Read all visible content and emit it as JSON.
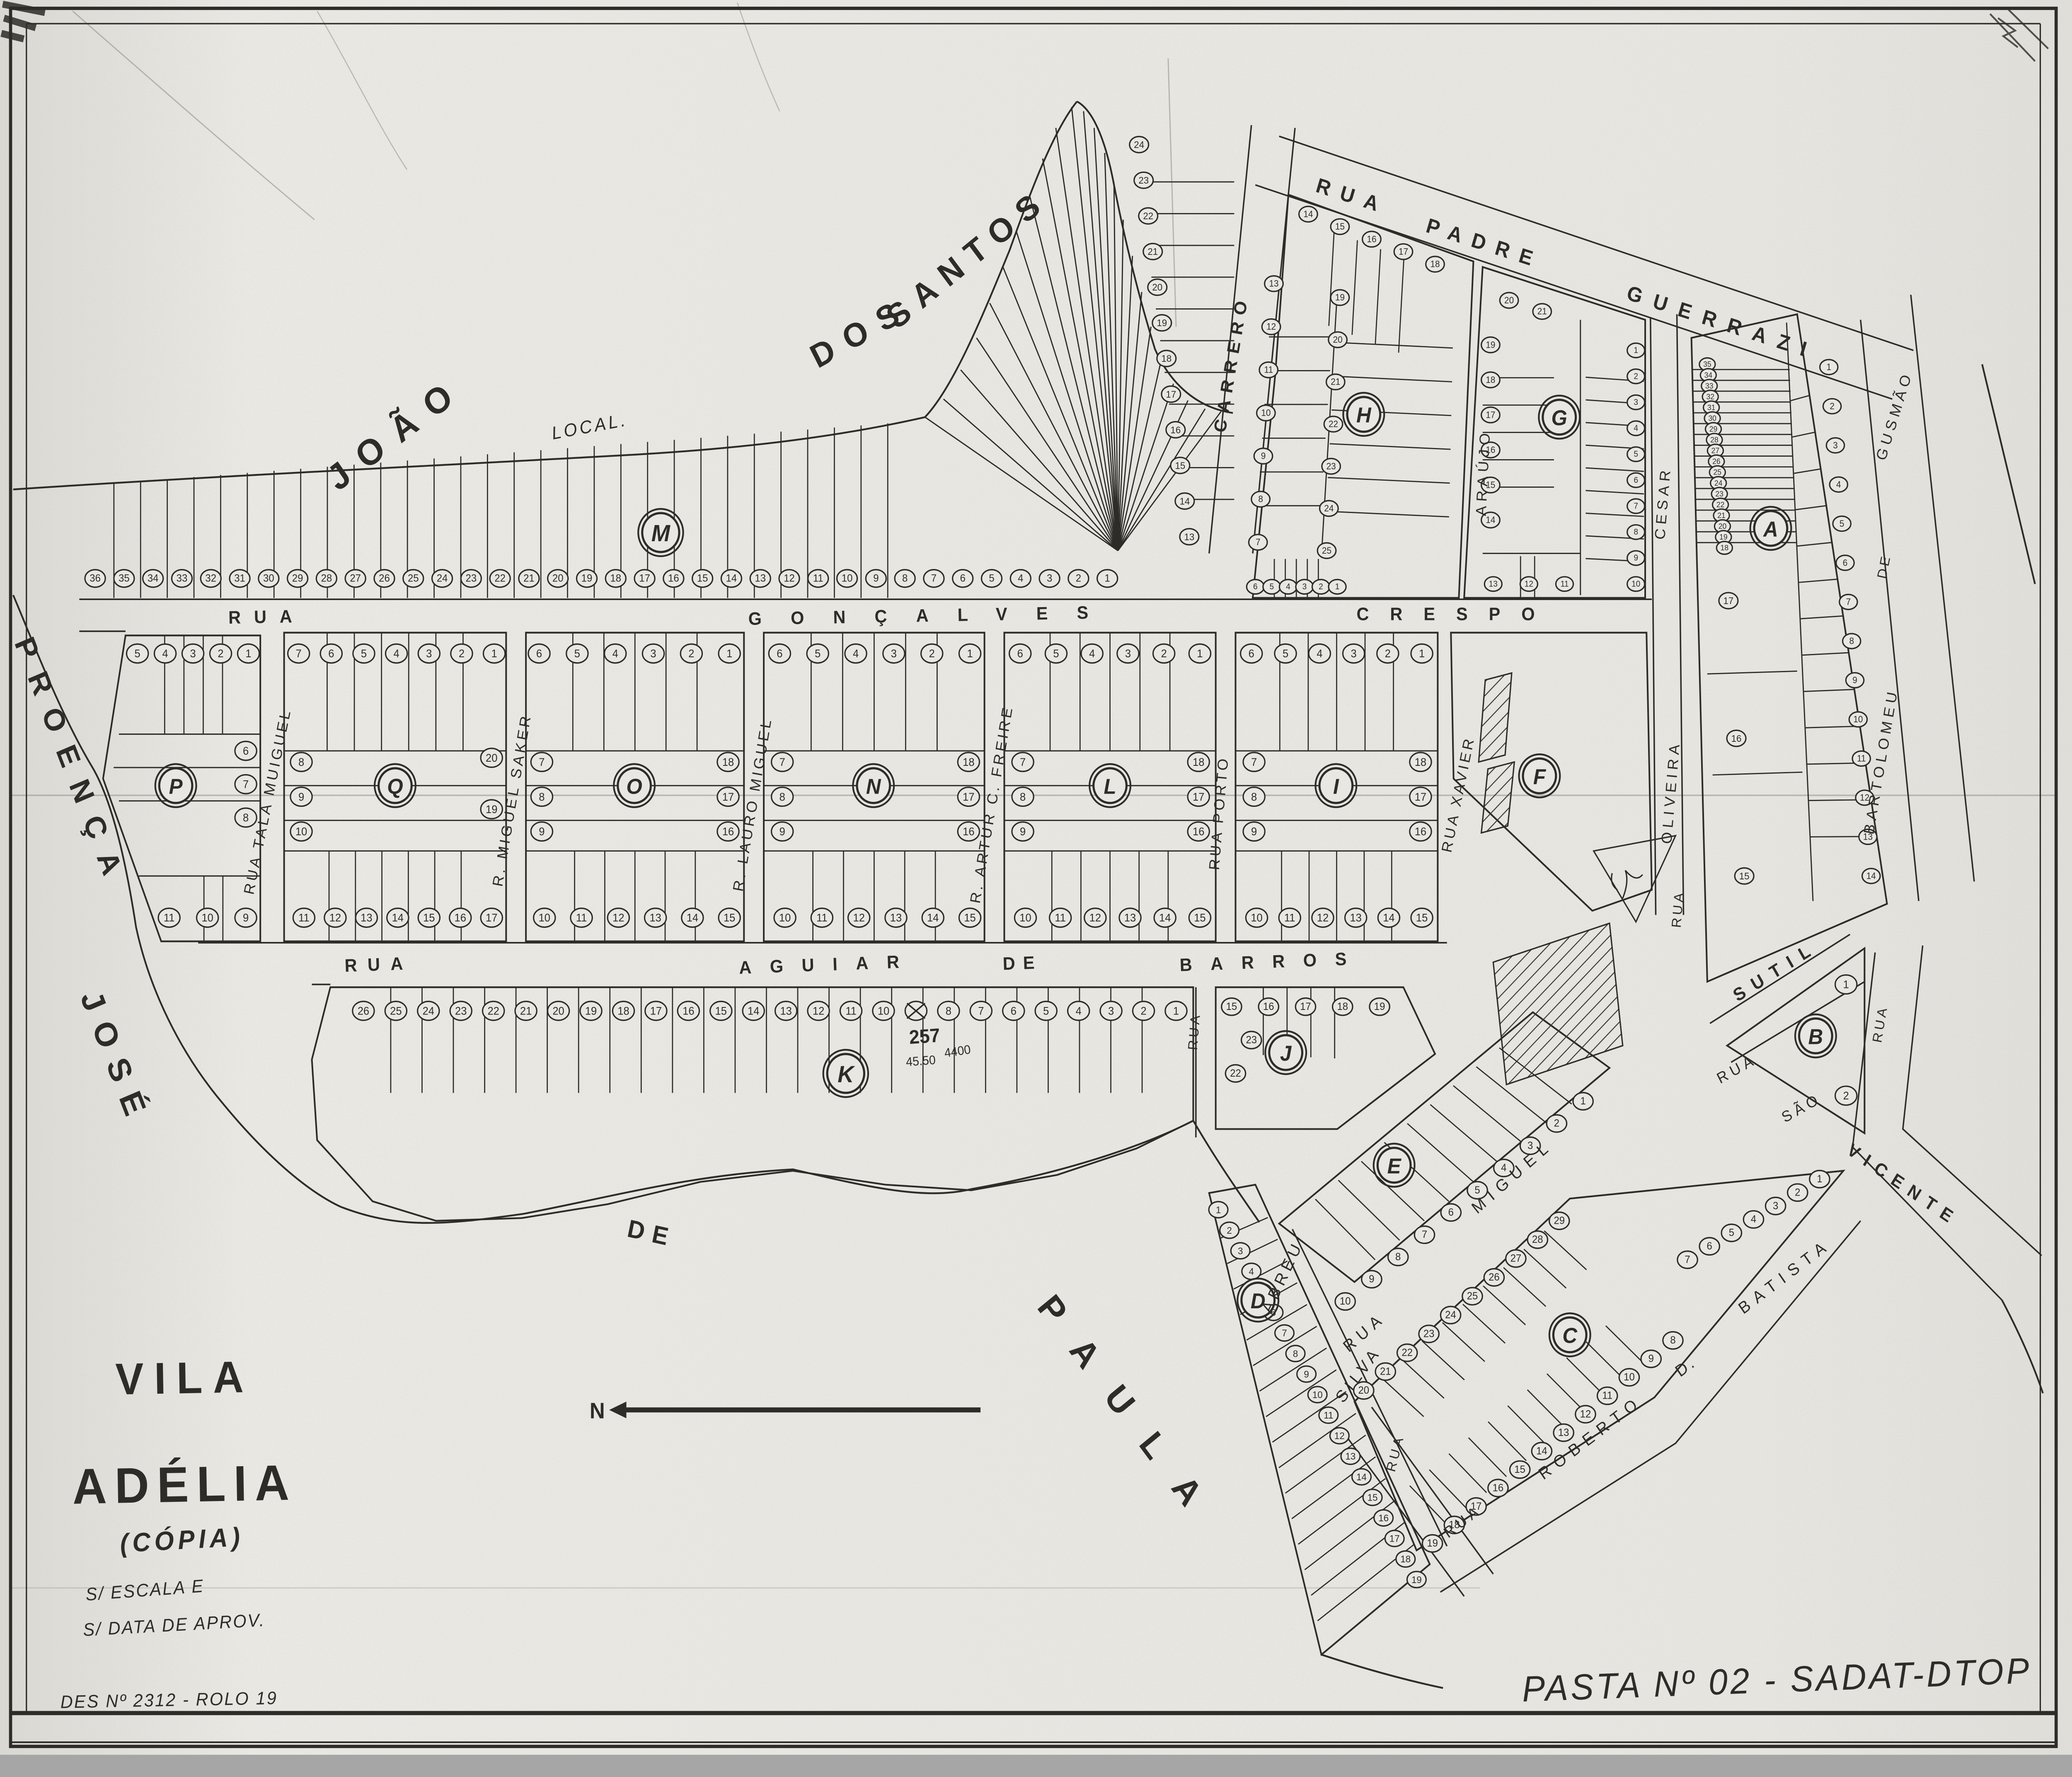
{
  "colors": {
    "ink": "#2e2c28",
    "paper": "#e9e7e2"
  },
  "title": {
    "word1": "VILA",
    "word2": "ADÉLIA",
    "subtitle": "(CÓPIA)",
    "note_line1": "S/ ESCALA E",
    "note_line2": "S/ DATA DE APROV."
  },
  "footer": {
    "drawing_ref": "DES Nº 2312 - ROLO 19",
    "folder_ref": "PASTA Nº 02 - SADAT-DTOP"
  },
  "north_indicator": "N",
  "boundaries": {
    "north_owner": [
      "JOÃO",
      "DOS",
      "SANTOS"
    ],
    "north_note": "LOCAL.",
    "west_owner": "PROENÇA",
    "south_owner_1": "JOSÉ",
    "south_owner_2": "DE",
    "south_owner_3": "PAULA"
  },
  "annotations": {
    "k_numbers": [
      "257",
      "45.50",
      "4400"
    ]
  },
  "streets": {
    "padre_guerrazi": [
      "RUA",
      "PADRE",
      "GUERRAZI"
    ],
    "carrero": "CARRERO",
    "araujo": "ARAÚJO",
    "goncalves_crespo": [
      "RUA",
      "GONÇALVES",
      "CRESPO"
    ],
    "aguiar_de_barros": [
      "RUA",
      "AGUIAR",
      "DE",
      "BARROS"
    ],
    "tala_muiguel": "RUA TALA MUIGUEL",
    "miguel_saker": "R. MIGUEL SAKER",
    "lauro_miguel": "R. LAURO MIGUEL",
    "artur_c_freire": "R. ARTUR C. FREIRE",
    "porto": "RUA PORTO",
    "xavier": "RUA XAVIER",
    "oliveira_cesar": [
      "RUA",
      "OLIVEIRA",
      "CESAR"
    ],
    "bartolomeu_de_gusmao": [
      "RUA",
      "BARTOLOMEU",
      "DE",
      "GUSMÃO"
    ],
    "sutil": "SUTIL",
    "sao_vicente": [
      "RUA",
      "SÃO",
      "VICENTE"
    ],
    "rua_unnamed": "RUA",
    "miguel": [
      "RUA",
      "MIGUEL"
    ],
    "abreu": "ABREU",
    "silva": [
      "RUA",
      "SILVA"
    ],
    "roberto_d_batista": [
      "RUA",
      "ROBERTO",
      "D.",
      "BATISTA"
    ]
  },
  "blocks": [
    {
      "id": "M",
      "letter": "M",
      "lots": {
        "strip": [
          "36",
          "35",
          "34",
          "33",
          "32",
          "31",
          "30",
          "29",
          "28",
          "27",
          "26",
          "25",
          "24",
          "23",
          "22",
          "21",
          "20",
          "19",
          "18",
          "17",
          "16",
          "15",
          "14",
          "13",
          "12",
          "11",
          "10",
          "9",
          "8",
          "7",
          "6",
          "5",
          "4",
          "3",
          "2",
          "1"
        ]
      }
    },
    {
      "id": "S",
      "letter": "",
      "lots": {
        "col": [
          "24",
          "23",
          "22",
          "21",
          "20",
          "19",
          "18",
          "17",
          "16",
          "15",
          "14",
          "13"
        ]
      }
    },
    {
      "id": "P",
      "letter": "P",
      "lots": {
        "top": [
          "5",
          "4",
          "3",
          "2",
          "1"
        ],
        "right": [
          "6",
          "7",
          "8"
        ],
        "bottom": [
          "11",
          "10",
          "9"
        ]
      }
    },
    {
      "id": "Q",
      "letter": "Q",
      "lots": {
        "top": [
          "7",
          "6",
          "5",
          "4",
          "3",
          "2",
          "1"
        ],
        "left": [
          "8",
          "9",
          "10"
        ],
        "right": [
          "20",
          "19"
        ],
        "bottom": [
          "11",
          "12",
          "13",
          "14",
          "15",
          "16",
          "17"
        ]
      }
    },
    {
      "id": "O",
      "letter": "O",
      "lots": {
        "top": [
          "6",
          "5",
          "4",
          "3",
          "2",
          "1"
        ],
        "left": [
          "7",
          "8",
          "9"
        ],
        "right": [
          "18",
          "17",
          "16"
        ],
        "bottom": [
          "10",
          "11",
          "12",
          "13",
          "14",
          "15"
        ]
      }
    },
    {
      "id": "N",
      "letter": "N",
      "lots": {
        "top": [
          "6",
          "5",
          "4",
          "3",
          "2",
          "1"
        ],
        "left": [
          "7",
          "8",
          "9"
        ],
        "right": [
          "18",
          "17",
          "16"
        ],
        "bottom": [
          "10",
          "11",
          "12",
          "13",
          "14",
          "15"
        ]
      }
    },
    {
      "id": "L",
      "letter": "L",
      "lots": {
        "top": [
          "6",
          "5",
          "4",
          "3",
          "2",
          "1"
        ],
        "left": [
          "7",
          "8",
          "9"
        ],
        "right": [
          "18",
          "17",
          "16"
        ],
        "bottom": [
          "10",
          "11",
          "12",
          "13",
          "14",
          "15"
        ]
      }
    },
    {
      "id": "I",
      "letter": "I",
      "lots": {
        "top": [
          "6",
          "5",
          "4",
          "3",
          "2",
          "1"
        ],
        "left": [
          "7",
          "8",
          "9"
        ],
        "right": [
          "18",
          "17",
          "16"
        ],
        "bottom": [
          "10",
          "11",
          "12",
          "13",
          "14",
          "15"
        ]
      }
    },
    {
      "id": "H",
      "letter": "H",
      "lots": {
        "top": [
          "14",
          "15",
          "16",
          "17",
          "18"
        ],
        "left": [
          "13",
          "12",
          "11",
          "10",
          "9",
          "8",
          "7"
        ],
        "mid": [
          "19",
          "20",
          "21",
          "22",
          "23",
          "24",
          "25"
        ],
        "bottom": [
          "6",
          "5",
          "4",
          "3",
          "2",
          "1"
        ]
      }
    },
    {
      "id": "G",
      "letter": "G",
      "lots": {
        "top": [
          "20",
          "21"
        ],
        "left": [
          "19",
          "18",
          "17",
          "16",
          "15",
          "14"
        ],
        "bottom": [
          "13",
          "12",
          "11"
        ],
        "right": [
          "1",
          "2",
          "3",
          "4",
          "5",
          "6",
          "7",
          "8",
          "9",
          "10"
        ]
      }
    },
    {
      "id": "A",
      "letter": "A",
      "lots": {
        "left_upper": [
          "35",
          "34",
          "33",
          "32",
          "31",
          "30",
          "29",
          "28",
          "27",
          "26",
          "25",
          "24",
          "23",
          "22",
          "21",
          "20",
          "19",
          "18"
        ],
        "left_lower": [
          "17",
          "16",
          "15"
        ],
        "right": [
          "1",
          "2",
          "3",
          "4",
          "5",
          "6",
          "7",
          "8",
          "9",
          "10",
          "11",
          "12",
          "13",
          "14"
        ]
      }
    },
    {
      "id": "F",
      "letter": "F",
      "lots": {}
    },
    {
      "id": "B",
      "letter": "B",
      "lots": {
        "main": [
          "1",
          "2"
        ]
      }
    },
    {
      "id": "J",
      "letter": "J",
      "lots": {
        "top": [
          "15",
          "16",
          "17",
          "18",
          "19"
        ],
        "left": [
          "23",
          "22"
        ]
      }
    },
    {
      "id": "K",
      "letter": "K",
      "crossed_lot": "9",
      "lots": {
        "strip": [
          "26",
          "25",
          "24",
          "23",
          "22",
          "21",
          "20",
          "19",
          "18",
          "17",
          "16",
          "15",
          "14",
          "13",
          "12",
          "11",
          "10",
          "9",
          "8",
          "7",
          "6",
          "5",
          "4",
          "3",
          "2",
          "1"
        ]
      }
    },
    {
      "id": "E",
      "letter": "E",
      "lots": {
        "edge": [
          "1",
          "2",
          "3",
          "4",
          "5",
          "6",
          "7",
          "8",
          "9",
          "10"
        ]
      }
    },
    {
      "id": "C",
      "letter": "C",
      "lots": {
        "ne": [
          "1",
          "2",
          "3",
          "4",
          "5",
          "6",
          "7"
        ],
        "nw": [
          "29",
          "28",
          "27",
          "26",
          "25",
          "24",
          "23",
          "22",
          "21",
          "20"
        ],
        "se": [
          "8",
          "9",
          "10",
          "11",
          "12",
          "13",
          "14",
          "15",
          "16",
          "17",
          "18",
          "19"
        ]
      }
    },
    {
      "id": "D",
      "letter": "D",
      "lots": {
        "edge": [
          "1",
          "2",
          "3",
          "4",
          "5",
          "6",
          "7",
          "8",
          "9",
          "10",
          "11",
          "12",
          "13",
          "14",
          "15",
          "16",
          "17",
          "18",
          "19"
        ]
      }
    }
  ]
}
